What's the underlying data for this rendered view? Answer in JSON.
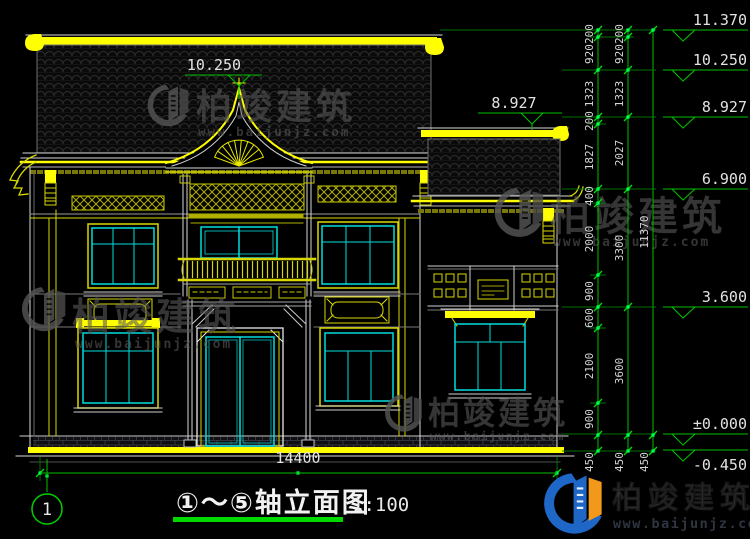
{
  "drawing_title": {
    "label": "①～⑤轴立面图",
    "scale": "1:100"
  },
  "axis_bubble": {
    "number": "1"
  },
  "dimensions": {
    "overall_width": "14400",
    "chain_inner": [
      "200",
      "920",
      "1323",
      "200",
      "1827",
      "400",
      "2000",
      "900",
      "600",
      "2100",
      "900",
      "450"
    ],
    "chain_middle": [
      "200",
      "920",
      "1323",
      "2027",
      "3300",
      "3600",
      "450"
    ],
    "chain_total": [
      "11370",
      "450"
    ]
  },
  "elevation_markers": {
    "right_edge": [
      "11.370",
      "10.250",
      "8.927",
      "6.900",
      "3.600",
      "±0.000",
      "-0.450"
    ],
    "main_ridge_center": "10.250",
    "wing_ridge": "8.927"
  },
  "watermark": {
    "brand": "柏竣建筑",
    "site": "www.baijunjz.com"
  },
  "footer_logo": {
    "brand": "柏竣建筑",
    "site": "www.baijunjz.com"
  },
  "colors": {
    "dimension_green": "#00c000",
    "detail_yellow": "#ffff00",
    "window_cyan": "#00dede",
    "line_white": "#d8d8d8",
    "logo_blue": "#1e67c6",
    "logo_orange": "#f2991c"
  }
}
